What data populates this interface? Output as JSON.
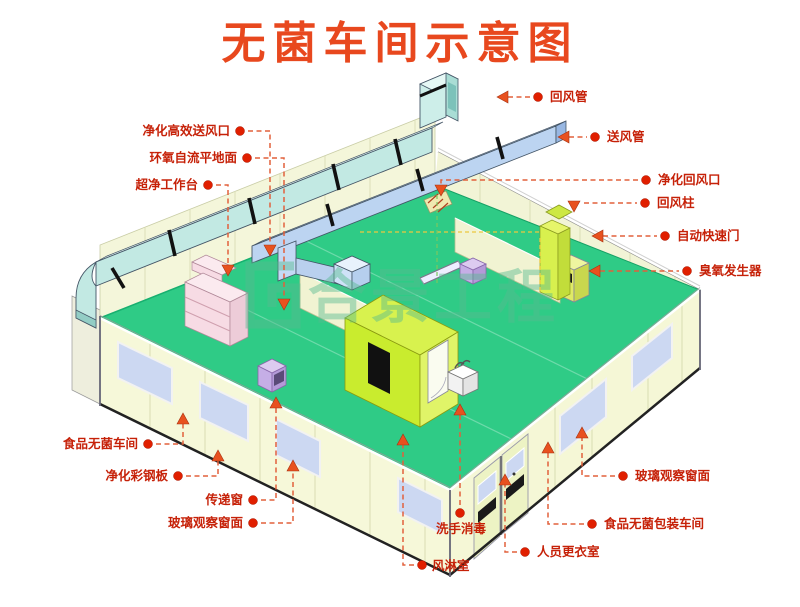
{
  "title": "无菌车间示意图",
  "watermark": {
    "text": "合景工程"
  },
  "labels": {
    "hepa_supply_outlet": "净化高效送风口",
    "epoxy_floor": "环氧自流平地面",
    "clean_bench": "超净工作台",
    "food_sterile_workshop": "食品无菌车间",
    "purification_steel_panel": "净化彩钢板",
    "pass_window": "传递窗",
    "glass_window_left": "玻璃观察窗面",
    "return_air_duct": "回风管",
    "supply_air_duct": "送风管",
    "purified_return_inlet": "净化回风口",
    "return_air_column": "回风柱",
    "auto_fast_door": "自动快速门",
    "ozone_generator": "臭氧发生器",
    "glass_window_right": "玻璃观察窗面",
    "sterile_packing_workshop": "食品无菌包装车间",
    "changing_room": "人员更衣室",
    "hand_wash": "洗手消毒",
    "air_shower": "风淋室"
  },
  "colors": {
    "title_red": "#e8481e",
    "label_red": "#c62108",
    "leader_red": "#e2603c",
    "floor_green": "#2fcb86",
    "wall_cream": "#f6f8d9",
    "duct_cyan": "#c2e9e3",
    "duct_blue": "#bcd4f1",
    "window_lavender": "#ccd8f2",
    "air_shower_green": "#c9ec2e",
    "bench_pink": "#f7dbe4",
    "machine_yellow": "#e0ea66",
    "machine_purple": "#c5aee6",
    "watermark_green": "#57bb90"
  }
}
